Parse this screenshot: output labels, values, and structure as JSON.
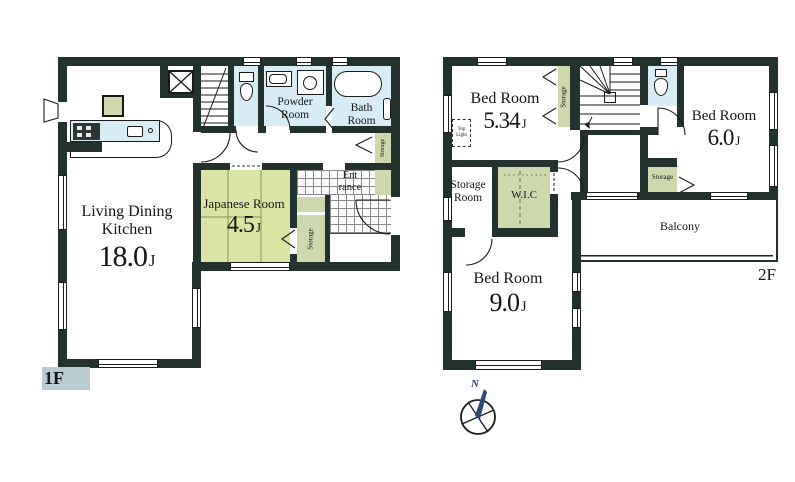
{
  "colors": {
    "wall": "#24322e",
    "water": "#d7ecf5",
    "tatami": "#d9e5a2",
    "green": "#cdd8ac",
    "compass": "#2a4879",
    "label_bg": "#b7cbd0"
  },
  "f1": {
    "label": "1F",
    "ldk": {
      "line1": "Living Dining",
      "line2": "Kitchen",
      "size": "18.0",
      "unit": "J"
    },
    "japanese": {
      "name": "Japanese Room",
      "size": "4.5",
      "unit": "J"
    },
    "powder": {
      "line1": "Powder",
      "line2": "Room"
    },
    "bath": {
      "line1": "Bath",
      "line2": "Room"
    },
    "entrance": {
      "line1": "Ent",
      "line2": "rance"
    },
    "storage_hall": "Storage",
    "storage_closet": "Storage"
  },
  "f2": {
    "label": "2F",
    "bedroom1": {
      "name": "Bed Room",
      "size": "5.34",
      "unit": "J"
    },
    "bedroom2": {
      "name": "Bed Room",
      "size": "6.0",
      "unit": "J"
    },
    "bedroom3": {
      "name": "Bed Room",
      "size": "9.0",
      "unit": "J"
    },
    "storage_room": {
      "line1": "Storage",
      "line2": "Room"
    },
    "wic": "W.I.C",
    "storage_stairs": "Storage",
    "storage_bed": "Storage",
    "top_light": {
      "line1": "Top",
      "line2": "Light"
    },
    "balcony": "Balcony"
  },
  "compass": {
    "north": "N"
  }
}
